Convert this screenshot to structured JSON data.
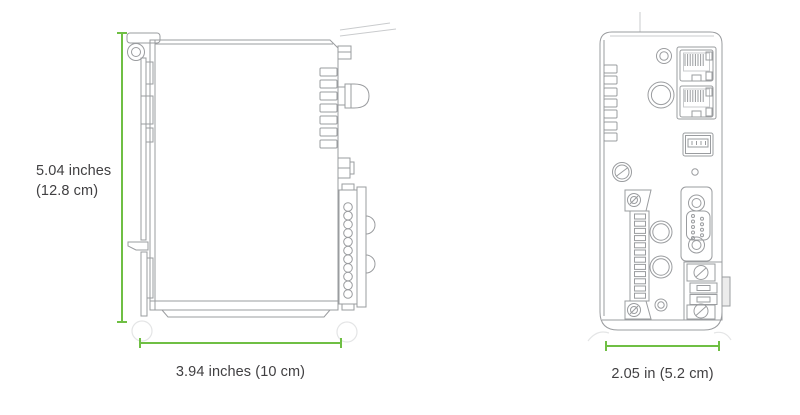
{
  "theme": {
    "accent": "#6fbf44",
    "line": "#9a9c9f",
    "line-light": "#c9cbcd",
    "ghost": "#e4e5e6",
    "text": "#414042",
    "background": "#ffffff"
  },
  "diagram": {
    "side_view": {
      "height_label_line1": "5.04 inches",
      "height_label_line2": "(12.8 cm)",
      "width_label": "3.94 inches (10 cm)"
    },
    "front_view": {
      "width_label": "2.05 in (5.2 cm)"
    }
  }
}
